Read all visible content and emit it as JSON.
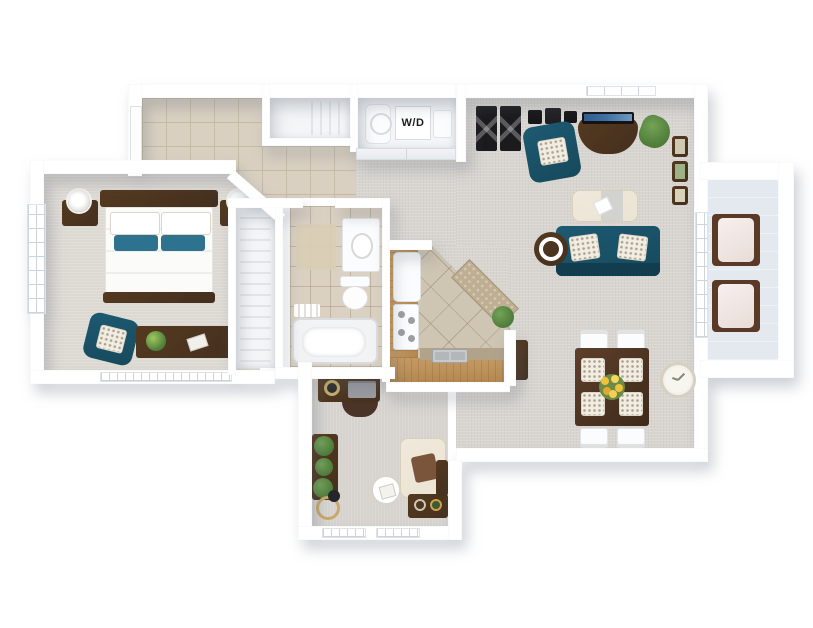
{
  "title": "3D apartment floor plan",
  "labels": {
    "washer_dryer": "W/D"
  },
  "colors": {
    "wall": "#ffffff",
    "wall_edge": "#d8dee6",
    "carpet": "#d8d5d0",
    "carpet_bedroom": "#dcd8d2",
    "carpet_den": "#d6d3ce",
    "entry_tile": "#d9d0c1",
    "entry_tile_line": "#c6bba7",
    "bath_tile": "#dbd1c3",
    "kitchen_tile": "#cfc5b3",
    "counter_wood": "#c59a62",
    "counter_wood_dark": "#b2874f",
    "granite": "#beae92",
    "accent_teal": "#17495c",
    "accent_teal_light": "#2d7390",
    "dark_wood": "#44301f",
    "cream": "#ebe3d3",
    "closet_floor": "#f3f5f7",
    "balcony_floor": "#e4e9ef",
    "plant_green": "#4e7c3a",
    "floral_yellow": "#eec33c",
    "tv_screen": "#3f70a6"
  },
  "rooms": [
    {
      "name": "entry-hall",
      "floor": "tile",
      "features": [
        "front-door",
        "coat-closet"
      ]
    },
    {
      "name": "laundry-closet",
      "floor": "white",
      "label": "W/D",
      "features": [
        "washer",
        "dryer",
        "bifold-doors"
      ]
    },
    {
      "name": "bedroom",
      "floor": "carpet",
      "features": [
        "bed",
        "nightstands",
        "table-lamps",
        "teal-accent-chair",
        "dresser",
        "windows"
      ]
    },
    {
      "name": "closet",
      "floor": "white",
      "features": [
        "wire-shelving"
      ]
    },
    {
      "name": "bathroom",
      "floor": "tile",
      "features": [
        "vanity-sink",
        "toilet",
        "bathtub",
        "rug",
        "towel-bar"
      ]
    },
    {
      "name": "kitchen",
      "floor": "tile",
      "features": [
        "l-shaped-counter",
        "refrigerator",
        "range",
        "double-sink",
        "angled-breakfast-bar",
        "plant"
      ]
    },
    {
      "name": "living-room",
      "floor": "carpet",
      "features": [
        "bar-stools",
        "wall-shelves",
        "teal-armchair",
        "tv-console",
        "tv",
        "plant",
        "gallery-frames",
        "ottoman",
        "teal-sofa",
        "round-side-table"
      ]
    },
    {
      "name": "dining-area",
      "floor": "carpet",
      "features": [
        "dining-table",
        "four-chairs",
        "floral-centerpiece",
        "console-cabinet",
        "wall-clock"
      ]
    },
    {
      "name": "den-office",
      "floor": "carpet",
      "features": [
        "desk",
        "desk-chair",
        "laptop",
        "plant-stand",
        "floor-lamp",
        "round-table",
        "cream-armchair",
        "side-cabinet",
        "bookcase",
        "windows"
      ]
    },
    {
      "name": "balcony",
      "floor": "concrete",
      "features": [
        "patio-chair",
        "patio-chair",
        "french-door",
        "railing"
      ]
    }
  ]
}
